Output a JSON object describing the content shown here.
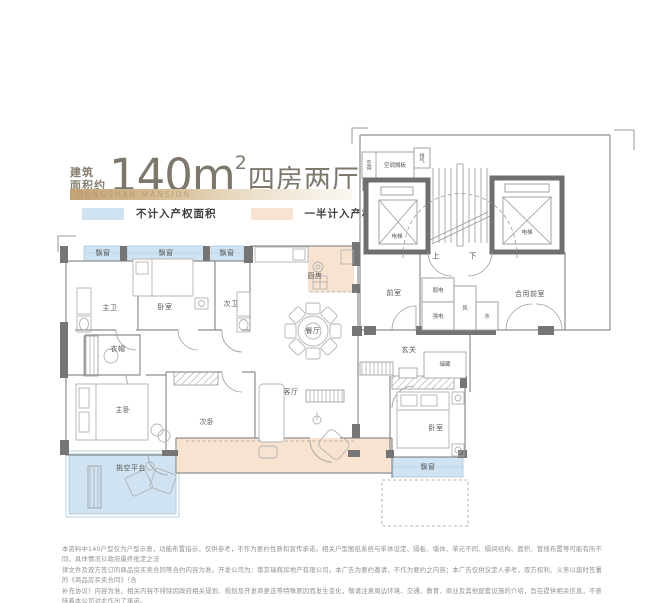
{
  "header": {
    "area_label_top": "建筑",
    "area_label_bottom": "面积约",
    "area_value": "140m",
    "area_superscript": "2",
    "layout_text": "四房两厅两卫",
    "banner": "DONGSHAN MANSION"
  },
  "legend": {
    "items": [
      {
        "label": "不计入产权面积",
        "color": "#cfe3f2"
      },
      {
        "label": "一半计入产权面积",
        "color": "#f8e3d0"
      }
    ]
  },
  "plan": {
    "colors": {
      "non_property_blue": "#cfe3f2",
      "half_property_peach": "#f8e3d0",
      "wall_dark": "#757575"
    },
    "labels": {
      "bay_window_1": "飘窗",
      "bay_window_2": "飘窗",
      "bay_window_3": "飘窗",
      "bay_window_4": "飘窗",
      "master_bath": "主卫",
      "bedroom_top": "卧室",
      "second_bath": "次卫",
      "cloakroom": "衣帽",
      "master_bedroom": "主卧",
      "second_bedroom": "次卧",
      "living_room": "客厅",
      "dining_room": "餐厅",
      "kitchen": "厨房",
      "foyer": "玄关",
      "storage": "储藏",
      "front_room": "前室",
      "weak_electric": "弱电",
      "strong_electric": "强电",
      "air_shaft": "风",
      "water_shaft": "水",
      "shared_front_room": "合用前室",
      "elevator_left": "电梯",
      "elevator_right": "电梯",
      "stairs_up": "上",
      "stairs_down": "下",
      "platform": "挑空平台",
      "ac_shelf": "空调搁板",
      "ac": "空调",
      "exhaust": "排气",
      "bedroom_right": "卧室"
    }
  },
  "footer": {
    "lines": [
      "本资料中140户型仅为户型示意，功能布置指示，仅供参考，不作为要约性质和宣传承诺。相关户型图纸系统与单体设定、隔板、墙体、单元不同、隔间结构、面积、管线布置等可能有所不同，具体情况以政府最终批定之法",
      "律文件及双方签订的商品房买卖合同等合约内容为准。开发公司为：南京瑞辉房地产有限公司。本广告为要约邀请，不作为要约之内容；本广告仅供议定人参考，双方权利、义务以届时签署的《商品房买卖合同》（含",
      "补充协议）内容为准。相关内容不排除因政府相关规划、规划及开发商更迭等特殊原因而发生变化，敬请注意周边环境、交通、教育、商业及其他配套设施的介绍，旨在提供相关信息，不意味着本公司对此作出了承诺。",
      "本公司保留对宣传资料修改的权利。本资料出版日期：2025年7月，有效期：1个月。"
    ]
  }
}
